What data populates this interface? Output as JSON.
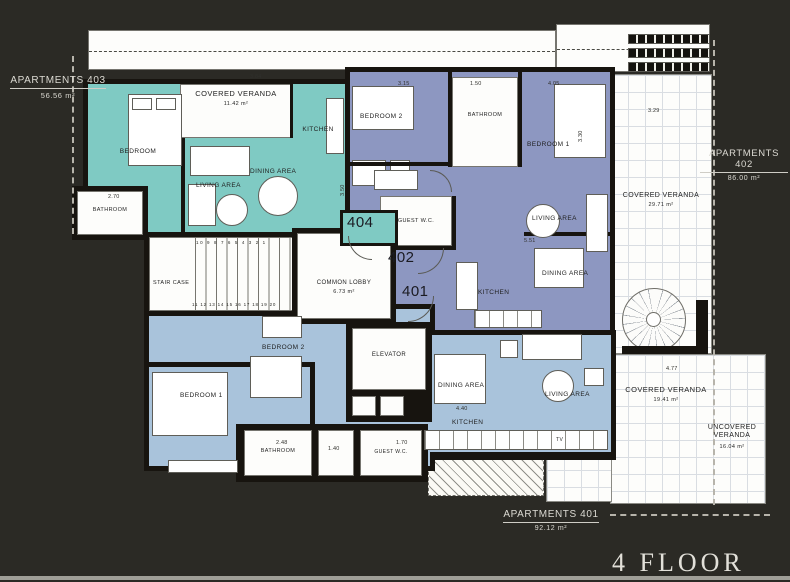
{
  "floor_title": "4  FLOOR",
  "apartments": {
    "a403": {
      "name": "APARTMENTS 403",
      "area": "56.56 m²",
      "unit": "404"
    },
    "a402": {
      "name": "APARTMENTS 402",
      "area": "86.00 m²",
      "unit": "402"
    },
    "a401": {
      "name": "APARTMENTS 401",
      "area": "92.12 m²",
      "unit": "401"
    }
  },
  "apt403": {
    "bedroom": "BEDROOM",
    "veranda": "COVERED VERANDA",
    "veranda_area": "11.42 m²",
    "kitchen": "KITCHEN",
    "living": "LIVING AREA",
    "dining": "DINING AREA",
    "bathroom": "BATHROOM"
  },
  "apt402": {
    "bedroom2": "BEDROOM 2",
    "bathroom": "BATHROOM",
    "bedroom1": "BEDROOM 1",
    "guest_wc": "GUEST W.C.",
    "living": "LIVING AREA",
    "dining": "DINING AREA",
    "kitchen": "KITCHEN"
  },
  "apt401": {
    "bedroom2": "BEDROOM 2",
    "bedroom1": "BEDROOM 1",
    "bathroom": "BATHROOM",
    "guest_wc": "GUEST W.C.",
    "dining": "DINING AREA",
    "living": "LIVING AREA",
    "kitchen": "KITCHEN",
    "tv": "TV"
  },
  "common": {
    "stair": "STAIR CASE",
    "stair_top": "10 9 8 7 6 5 4 3 2 1",
    "stair_bottom": "11 12 13 14 15 16 17 18 19 20",
    "lobby": "COMMON LOBBY",
    "lobby_area": "6.73 m²",
    "elevator": "ELEVATOR"
  },
  "verandas": {
    "right": {
      "label": "COVERED VERANDA",
      "area": "29.71 m²"
    },
    "bottom": {
      "label": "COVERED VERANDA",
      "area": "19.41 m²"
    },
    "uncovered": {
      "label": "UNCOVERED VERANDA",
      "area": "16.04 m²"
    }
  },
  "dims": {
    "d1": "3.84",
    "d2": "3.15",
    "d3": "1.50",
    "d4": "4.05",
    "d5": "3.30",
    "d6": "5.51",
    "d7": "2.70",
    "d8": "3.50",
    "d9": "2.48",
    "d10": "1.40",
    "d11": "1.70",
    "d12": "4.77",
    "d13": "3.29",
    "d14": "4.40"
  },
  "colors": {
    "background": "#2b2a25",
    "wall": "#17140f",
    "apt403": "#7fcac3",
    "apt402": "#8d97c1",
    "apt401": "#a9c3db",
    "veranda_grid": "#d9dde2",
    "label_text": "#dcdad3"
  }
}
